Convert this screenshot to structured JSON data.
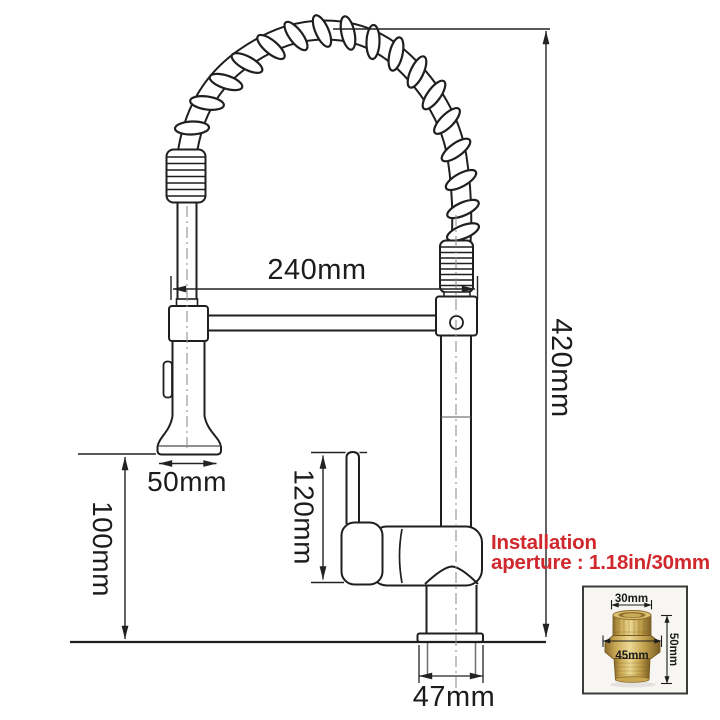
{
  "diagram": {
    "type": "technical-dimension-drawing",
    "subject": "pull-down spring kitchen faucet",
    "labels": {
      "spout_reach": "240mm",
      "total_height": "420mm",
      "sprayer_width": "50mm",
      "sprayer_clearance": "100mm",
      "handle_height": "120mm",
      "base_width": "47mm"
    },
    "note": {
      "line1": "Installation",
      "line2": "aperture : 1.18in/30mm",
      "color": "#d0282c"
    },
    "inset": {
      "labels": {
        "top_diameter": "30mm",
        "flange_width": "45mm",
        "fitting_height": "50mm"
      },
      "brass_color": "#c3a052",
      "background": "#f7f6f2"
    },
    "line_color": "#1f1f1f"
  }
}
